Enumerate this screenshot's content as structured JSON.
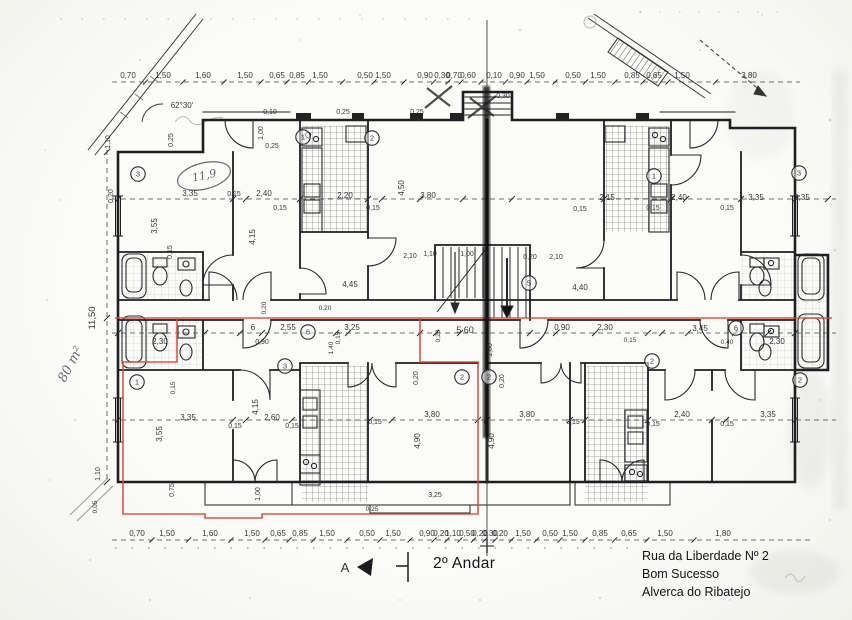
{
  "document": {
    "type": "architectural floor plan (scanned)",
    "floor_label": "2º Andar",
    "address": [
      "Rua da Liberdade Nº 2",
      "Bom Sucesso",
      "Alverca do Ribatejo"
    ]
  },
  "colors": {
    "ink": "#26262c",
    "highlight_red": "#d8453a",
    "paper": "#f8f8f5"
  },
  "plan": {
    "top_dims": [
      {
        "t": "0,70",
        "x": 128
      },
      {
        "t": "1,50",
        "x": 163
      },
      {
        "t": "1,60",
        "x": 203
      },
      {
        "t": "1,50",
        "x": 245
      },
      {
        "t": "0,65",
        "x": 277
      },
      {
        "t": "0,85",
        "x": 297
      },
      {
        "t": "1,50",
        "x": 320
      },
      {
        "t": "0,50",
        "x": 365
      },
      {
        "t": "1,50",
        "x": 383
      },
      {
        "t": "0,90",
        "x": 425
      },
      {
        "t": "0,30",
        "x": 442
      },
      {
        "t": "0,70",
        "x": 454
      },
      {
        "t": "0,60",
        "x": 468
      },
      {
        "t": "0,10",
        "x": 494
      },
      {
        "t": "0,90",
        "x": 517
      },
      {
        "t": "1,50",
        "x": 537
      },
      {
        "t": "0,50",
        "x": 573
      },
      {
        "t": "1,50",
        "x": 598
      },
      {
        "t": "0,85",
        "x": 632
      },
      {
        "t": "0,65",
        "x": 654
      },
      {
        "t": "1,50",
        "x": 682
      },
      {
        "t": "3,80",
        "x": 749
      }
    ],
    "bottom_dims": [
      {
        "t": "0,70",
        "x": 137
      },
      {
        "t": "1,50",
        "x": 167
      },
      {
        "t": "1,60",
        "x": 210
      },
      {
        "t": "1,50",
        "x": 252
      },
      {
        "t": "0,65",
        "x": 278
      },
      {
        "t": "0,85",
        "x": 300
      },
      {
        "t": "1,50",
        "x": 327
      },
      {
        "t": "0,50",
        "x": 367
      },
      {
        "t": "1,50",
        "x": 393
      },
      {
        "t": "0,90",
        "x": 427
      },
      {
        "t": "0,20",
        "x": 441
      },
      {
        "t": "1,10",
        "x": 453
      },
      {
        "t": "0,50",
        "x": 467
      },
      {
        "t": "0,20",
        "x": 480
      },
      {
        "t": "0,30",
        "x": 490
      },
      {
        "t": "0,20",
        "x": 500
      },
      {
        "t": "1,50",
        "x": 523
      },
      {
        "t": "0,50",
        "x": 550
      },
      {
        "t": "1,50",
        "x": 570
      },
      {
        "t": "0,85",
        "x": 600
      },
      {
        "t": "0,65",
        "x": 629
      },
      {
        "t": "1,50",
        "x": 665
      },
      {
        "t": "1,80",
        "x": 723
      }
    ],
    "labels": [
      {
        "t": "62°30'",
        "x": 182,
        "y": 108,
        "s": 8
      },
      {
        "t": "0,25",
        "x": 173,
        "y": 140,
        "r": -90,
        "s": 7
      },
      {
        "t": "0,10",
        "x": 270,
        "y": 114,
        "s": 7
      },
      {
        "t": "1,00",
        "x": 263,
        "y": 133,
        "r": -90,
        "s": 7
      },
      {
        "t": "0,25",
        "x": 272,
        "y": 148,
        "s": 7
      },
      {
        "t": "0,25",
        "x": 343,
        "y": 114,
        "s": 7
      },
      {
        "t": "0,25",
        "x": 417,
        "y": 114,
        "s": 7
      },
      {
        "t": "0,30",
        "x": 503,
        "y": 98,
        "s": 7
      },
      {
        "t": "1,10",
        "x": 110,
        "y": 142,
        "r": -90,
        "s": 7
      },
      {
        "t": "0,20",
        "x": 113,
        "y": 196,
        "r": -90,
        "s": 7
      },
      {
        "t": "3,35",
        "x": 190,
        "y": 196
      },
      {
        "t": "0,15",
        "x": 234,
        "y": 196,
        "s": 7
      },
      {
        "t": "2,40",
        "x": 264,
        "y": 196
      },
      {
        "t": "0,15",
        "x": 280,
        "y": 210,
        "s": 7
      },
      {
        "t": "3,55",
        "x": 157,
        "y": 226,
        "r": -90
      },
      {
        "t": "0,15",
        "x": 172,
        "y": 252,
        "r": -90,
        "s": 7
      },
      {
        "t": "4,15",
        "x": 255,
        "y": 237,
        "r": -90
      },
      {
        "t": "2,20",
        "x": 345,
        "y": 198
      },
      {
        "t": "0,15",
        "x": 373,
        "y": 210,
        "s": 7
      },
      {
        "t": "4,50",
        "x": 404,
        "y": 188,
        "r": -90
      },
      {
        "t": "3,80",
        "x": 428,
        "y": 198
      },
      {
        "t": "2,15",
        "x": 607,
        "y": 200
      },
      {
        "t": "0,15",
        "x": 580,
        "y": 211,
        "s": 7
      },
      {
        "t": "2,40",
        "x": 679,
        "y": 200
      },
      {
        "t": "0,15",
        "x": 653,
        "y": 210,
        "s": 7
      },
      {
        "t": "0,15",
        "x": 727,
        "y": 210,
        "s": 7
      },
      {
        "t": "3,35",
        "x": 756,
        "y": 200
      },
      {
        "t": "3,35",
        "x": 802,
        "y": 200
      },
      {
        "t": "1,10",
        "x": 430,
        "y": 256,
        "s": 7
      },
      {
        "t": "1,00",
        "x": 467,
        "y": 256,
        "s": 7
      },
      {
        "t": "0,20",
        "x": 530,
        "y": 259,
        "s": 7
      },
      {
        "t": "2,10",
        "x": 556,
        "y": 259,
        "s": 7
      },
      {
        "t": "2,10",
        "x": 410,
        "y": 258,
        "s": 7
      },
      {
        "t": "4,45",
        "x": 350,
        "y": 287
      },
      {
        "t": "4,40",
        "x": 580,
        "y": 290
      },
      {
        "t": "6",
        "x": 253,
        "y": 330,
        "s": 8
      },
      {
        "t": "2,55",
        "x": 288,
        "y": 330
      },
      {
        "t": "0,90",
        "x": 262,
        "y": 344,
        "s": 7
      },
      {
        "t": "0,15",
        "x": 340,
        "y": 338,
        "r": -90,
        "s": 6.5
      },
      {
        "t": "3,25",
        "x": 352,
        "y": 330
      },
      {
        "t": "1,40",
        "x": 333,
        "y": 348,
        "r": -90,
        "s": 6.5
      },
      {
        "t": "0,20",
        "x": 266,
        "y": 308,
        "r": -90,
        "s": 6.5
      },
      {
        "t": "0,20",
        "x": 325,
        "y": 310,
        "s": 6.5
      },
      {
        "t": "0,20",
        "x": 440,
        "y": 336,
        "r": -90,
        "s": 6.5
      },
      {
        "t": "5 60",
        "x": 465,
        "y": 333,
        "s": 9
      },
      {
        "t": "1,60",
        "x": 492,
        "y": 350,
        "r": -90,
        "s": 7
      },
      {
        "t": "0,90",
        "x": 562,
        "y": 330
      },
      {
        "t": "2,30",
        "x": 605,
        "y": 330
      },
      {
        "t": "0,15",
        "x": 630,
        "y": 342,
        "s": 6.5
      },
      {
        "t": "3,45",
        "x": 700,
        "y": 331
      },
      {
        "t": "0,40",
        "x": 727,
        "y": 344,
        "s": 6.5
      },
      {
        "t": "2,30",
        "x": 777,
        "y": 344,
        "s": 8
      },
      {
        "t": "2,30",
        "x": 160,
        "y": 344,
        "s": 8
      },
      {
        "t": "11,50",
        "x": 95,
        "y": 318,
        "r": -90,
        "s": 9.5
      },
      {
        "t": "0,75",
        "x": 174,
        "y": 490,
        "r": -90,
        "s": 7
      },
      {
        "t": "1,10",
        "x": 100,
        "y": 474,
        "r": -90,
        "s": 7
      },
      {
        "t": "0,05",
        "x": 97,
        "y": 507,
        "r": -90,
        "s": 6.5
      },
      {
        "t": "0,15",
        "x": 175,
        "y": 388,
        "r": -90,
        "s": 6.5
      },
      {
        "t": "3,35",
        "x": 188,
        "y": 420
      },
      {
        "t": "3,55",
        "x": 162,
        "y": 434,
        "r": -90
      },
      {
        "t": "0,15",
        "x": 235,
        "y": 428,
        "s": 7
      },
      {
        "t": "2,60",
        "x": 272,
        "y": 420
      },
      {
        "t": "4,15",
        "x": 258,
        "y": 407,
        "r": -90
      },
      {
        "t": "0,15",
        "x": 292,
        "y": 428,
        "s": 7
      },
      {
        "t": "1,00",
        "x": 260,
        "y": 494,
        "r": -90,
        "s": 7
      },
      {
        "t": "0,20",
        "x": 418,
        "y": 378,
        "r": -90,
        "s": 7
      },
      {
        "t": "3,80",
        "x": 432,
        "y": 417
      },
      {
        "t": "4,90",
        "x": 420,
        "y": 441,
        "r": -90
      },
      {
        "t": "0,15",
        "x": 375,
        "y": 424,
        "s": 7
      },
      {
        "t": "3,25",
        "x": 435,
        "y": 497,
        "s": 7
      },
      {
        "t": "0,25",
        "x": 372,
        "y": 511,
        "s": 6.5
      },
      {
        "t": "0,20",
        "x": 504,
        "y": 381,
        "r": -90,
        "s": 7
      },
      {
        "t": "4,90",
        "x": 494,
        "y": 441,
        "r": -90
      },
      {
        "t": "3,80",
        "x": 527,
        "y": 417
      },
      {
        "t": "0,15",
        "x": 573,
        "y": 424,
        "s": 7
      },
      {
        "t": "2,40",
        "x": 682,
        "y": 417
      },
      {
        "t": "0,15",
        "x": 653,
        "y": 426,
        "s": 7
      },
      {
        "t": "0,15",
        "x": 727,
        "y": 426,
        "s": 7
      },
      {
        "t": "3,35",
        "x": 768,
        "y": 417
      },
      {
        "t": "A",
        "x": 345,
        "y": 572,
        "s": 13
      }
    ],
    "circles": [
      {
        "t": "3",
        "x": 138,
        "y": 174
      },
      {
        "t": "2",
        "x": 372,
        "y": 138
      },
      {
        "t": "1",
        "x": 303,
        "y": 137
      },
      {
        "t": "1",
        "x": 654,
        "y": 176
      },
      {
        "t": "3",
        "x": 799,
        "y": 173
      },
      {
        "t": "5",
        "x": 529,
        "y": 283
      },
      {
        "t": "6",
        "x": 308,
        "y": 332
      },
      {
        "t": "6",
        "x": 736,
        "y": 328
      },
      {
        "t": "1",
        "x": 137,
        "y": 382
      },
      {
        "t": "3",
        "x": 285,
        "y": 366
      },
      {
        "t": "2",
        "x": 462,
        "y": 377
      },
      {
        "t": "2",
        "x": 489,
        "y": 377
      },
      {
        "t": "2",
        "x": 652,
        "y": 361
      },
      {
        "t": "2",
        "x": 800,
        "y": 380
      }
    ],
    "hand_labels": [
      {
        "t": "80 m²",
        "x": 74,
        "y": 366,
        "r": -62,
        "s": 13
      },
      {
        "t": "11,9",
        "x": 205,
        "y": 179,
        "r": -12,
        "s": 11
      }
    ]
  }
}
